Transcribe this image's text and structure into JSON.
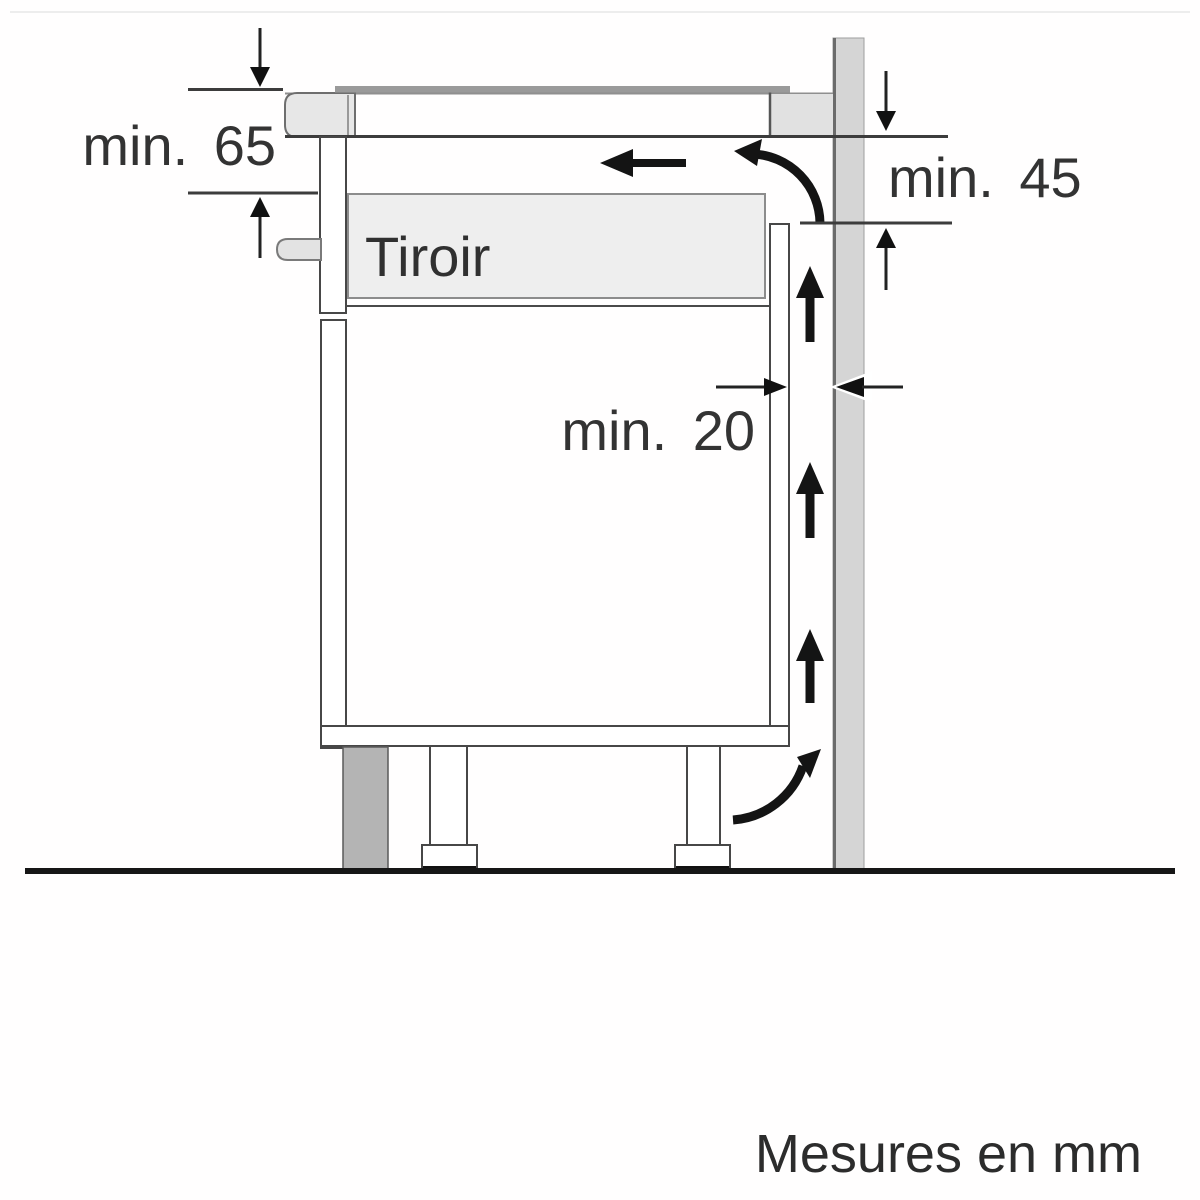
{
  "diagram": {
    "type": "appliance-installation-clearance-diagram",
    "caption": "Mesures en mm",
    "unit": "mm",
    "drawer_label": "Tiroir",
    "dimensions": [
      {
        "id": "worktop-to-drawer-top",
        "label": "min. 65",
        "value_mm": 65
      },
      {
        "id": "worktop-bottom-to-cabinet-panel",
        "label": "min. 45",
        "value_mm": 45
      },
      {
        "id": "rear-ventilation-gap",
        "label": "min. 20",
        "value_mm": 20
      }
    ],
    "icons": [
      "airflow-left-arrow-icon",
      "airflow-curve-top-icon",
      "airflow-up-arrow-icon",
      "airflow-curve-bottom-icon",
      "dimension-arrow-icon"
    ],
    "colors": {
      "background": "#ffffff",
      "line": "#3c3c3c",
      "wall_fill": "#d5d5d5",
      "wall_edge": "#6b6b6b",
      "worktop_edge_fill": "#e7e7e7",
      "worktop_rear_fill": "#e1e1e1",
      "drawer_fill": "#eeeeee",
      "handle_fill": "#e3e3e3",
      "glass_fill": "#9a9a9a",
      "plinth_fill": "#b4b4b4",
      "ground": "#161616",
      "arrow": "#141414"
    }
  }
}
